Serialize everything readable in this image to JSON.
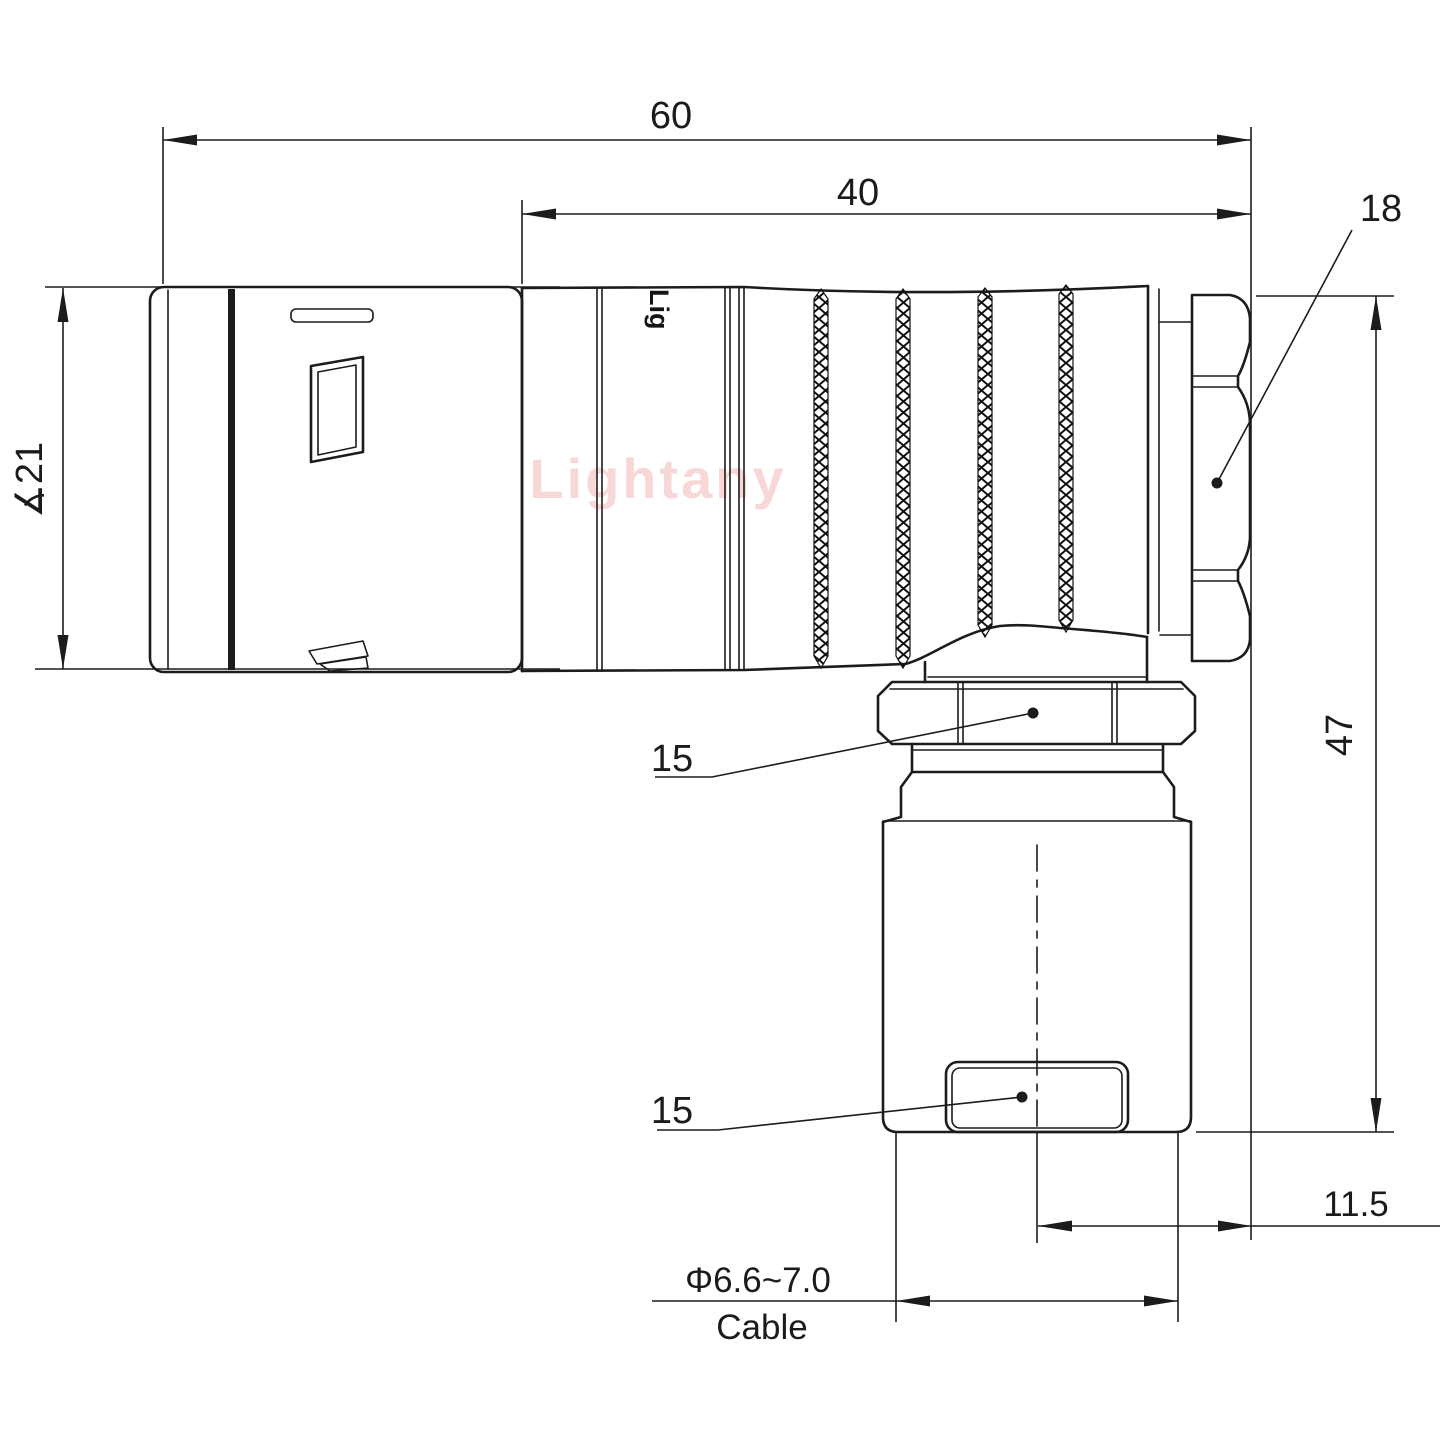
{
  "drawing": {
    "watermark": "Lightany",
    "engraving": "Lig",
    "colors": {
      "line": "#1c1c1c",
      "watermark": "#f7d8d6",
      "background": "#ffffff"
    },
    "dimensions": {
      "overall_length": "60",
      "body_length": "40",
      "back_nut_size": "18",
      "shell_diameter": "∡21",
      "total_height": "47",
      "elbow_nut_size": "15",
      "cable_clamp_size": "15",
      "side_offset": "11.5",
      "cable_diameter": "Φ6.6~7.0",
      "cable_label": "Cable"
    }
  }
}
